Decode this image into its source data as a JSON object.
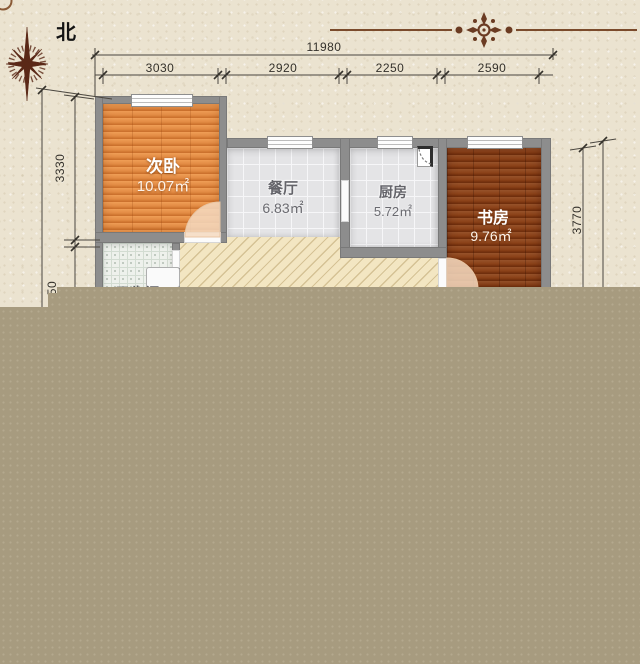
{
  "compass": {
    "north_label": "北"
  },
  "dimensions": {
    "top_total": "11980",
    "top_segments": [
      "3030",
      "2920",
      "2250",
      "2590"
    ],
    "left_vertical": "3330",
    "left_vertical_partial": "50",
    "right_vertical": "3770"
  },
  "rooms": {
    "bedroom": {
      "name": "次卧",
      "area": "10.07㎡"
    },
    "dining": {
      "name": "餐厅",
      "area": "6.83㎡"
    },
    "kitchen": {
      "name": "厨房",
      "area": "5.72㎡"
    },
    "study": {
      "name": "书房",
      "area": "9.76㎡"
    },
    "bathroom": {
      "name": "卫生间"
    }
  },
  "colors": {
    "parchment": "#ebe3d0",
    "overlay_block": "#a79b7f",
    "wall_gray": "#8d8d8d",
    "bedroom_wood": "#e28b44",
    "study_wood": "#8a4118",
    "tile_gray": "#e4e4e6",
    "hatch_cream": "#f3e6c2",
    "accent_brown": "#6b3a22",
    "dim_line": "#4a463f"
  }
}
